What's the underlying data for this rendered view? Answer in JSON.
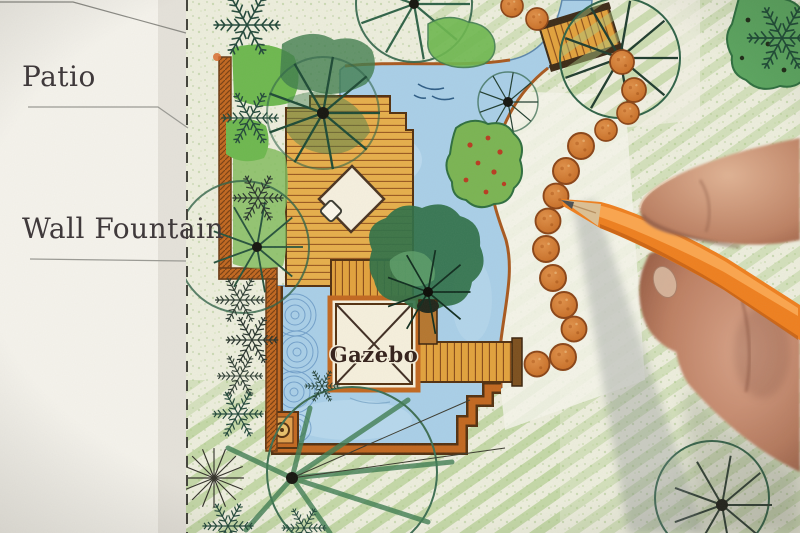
{
  "plan": {
    "labels": {
      "patio": "Patio",
      "wall_fountain": "Wall Fountain",
      "gazebo": "Gazebo"
    }
  },
  "palette": {
    "paper": "#f5f3ec",
    "lawn": "#edeedd",
    "lawn_stripe": "#a9c983",
    "water": "#a9cfe8",
    "water_edge": "#5b86ab",
    "deck_wood": "#e6ae4a",
    "deck_line": "#9a5a20",
    "wall_brick": "#c2671f",
    "stepping_stone": "#d9813a",
    "tree_green": "#2f6247",
    "shrub_green": "#6db84e",
    "pencil_orange": "#ef7f1e",
    "hand_skin": "#c58e70",
    "label_text": "#3b3537"
  }
}
